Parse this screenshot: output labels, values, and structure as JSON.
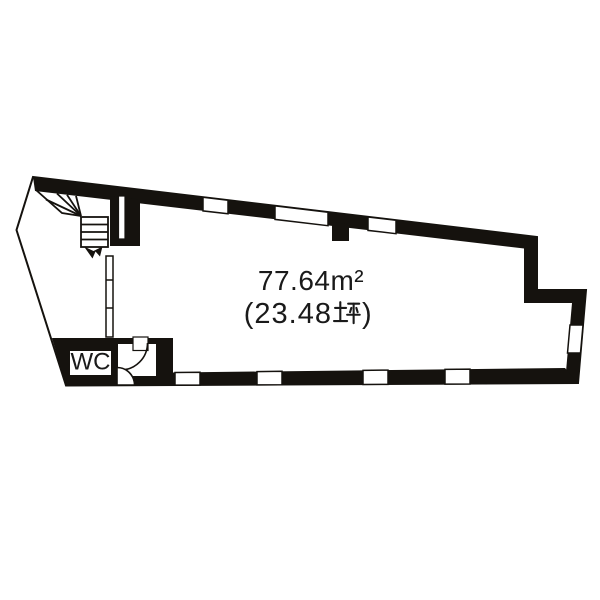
{
  "floor_plan": {
    "area_sqm_label": "77.64m²",
    "area_tsubo_label": "(23.48坪)",
    "area_tsubo_prefix": "(23.48",
    "area_tsubo_suffix": ")",
    "rooms": [
      {
        "name": "toilet",
        "label": "WC"
      }
    ],
    "icons": [
      "staircase-icon",
      "stair-direction-arrow-icon",
      "door-swing-arc-icon",
      "tsubo-kanji-icon",
      "window-opening-icon"
    ],
    "colors": {
      "wall": "#15120e",
      "background": "#ffffff",
      "text": "#1a1a1a"
    }
  }
}
